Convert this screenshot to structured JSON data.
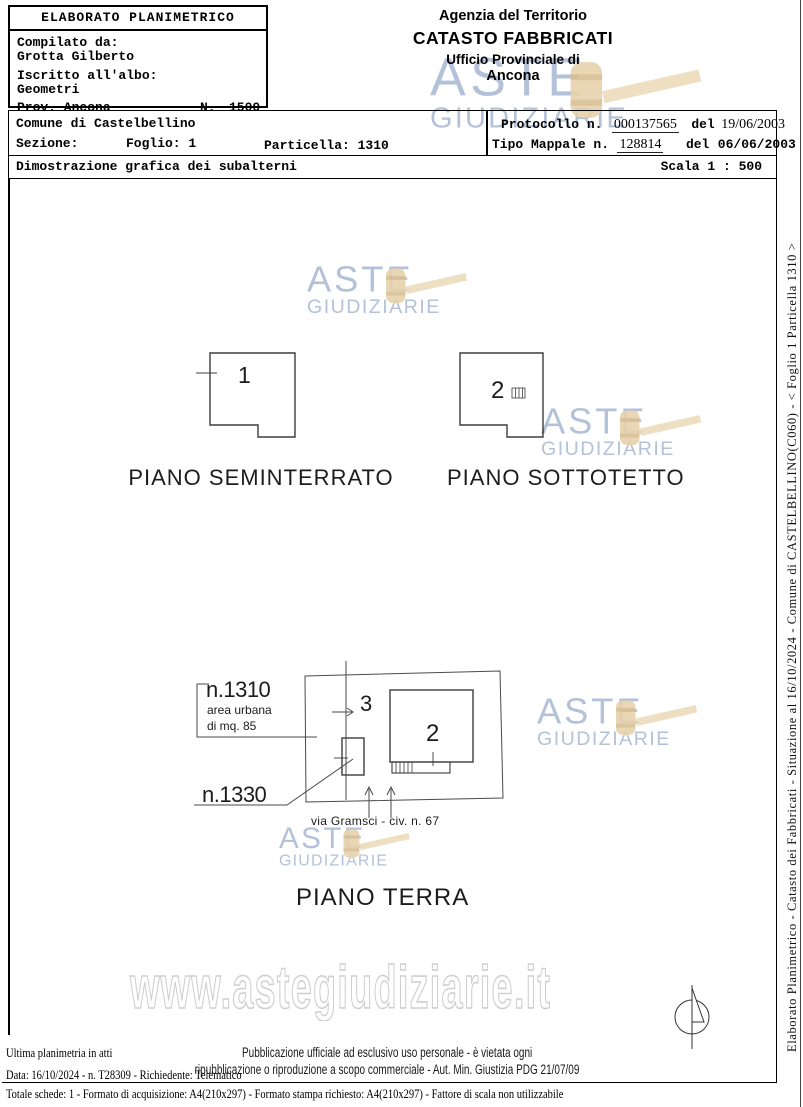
{
  "elaborato_box": {
    "title": "ELABORATO PLANIMETRICO",
    "compilato_label": "Compilato da:",
    "compilato_value": "Grotta Gilberto",
    "albo_label": "Iscritto all'albo:",
    "albo_value": "Geometri",
    "provincia": "Prov. Ancona",
    "numero_label": "N.",
    "numero_value": "1500"
  },
  "agenzia": {
    "line1": "Agenzia del Territorio",
    "line2": "CATASTO FABBRICATI",
    "line3": "Ufficio Provinciale di",
    "line4": "Ancona"
  },
  "intestazione": {
    "comune": "Comune di Castelbellino",
    "sezione": "Sezione:",
    "foglio": "Foglio: 1",
    "particella": "Particella: 1310",
    "protocollo_label": "Protocollo n.",
    "protocollo_value": "000137565",
    "protocollo_del": "del",
    "protocollo_data": "19/06/2003",
    "mappale_label": "Tipo Mappale n.",
    "mappale_value": "128814",
    "mappale_del": "del",
    "mappale_data": "06/06/2003",
    "descrizione": "Dimostrazione grafica dei subalterni",
    "scala": "Scala 1 : 500"
  },
  "planimetria": {
    "piano_seminterrato": {
      "label": "PIANO SEMINTERRATO",
      "sub": "1"
    },
    "piano_sottotetto": {
      "label": "PIANO SOTTOTETTO",
      "sub": "2"
    },
    "piano_terra": {
      "label": "PIANO TERRA",
      "sub3": "3",
      "sub2": "2",
      "particella_1310": "n.1310",
      "area_urbana": "area urbana",
      "mq": "di mq. 85",
      "particella_1330": "n.1330",
      "via": "via Gramsci - civ. n. 67"
    }
  },
  "watermark": {
    "aste": "ASTE",
    "giudiziarie": "GIUDIZIARIE",
    "url": "www.astegiudiziarie.it"
  },
  "footer": {
    "ultima": "Ultima planimetria in atti",
    "pubblicazione1": "Pubblicazione ufficiale ad esclusivo uso personale - è vietata ogni",
    "pubblicazione2": "ripubblicazione o riproduzione a scopo commerciale - Aut. Min. Giustizia PDG 21/07/09",
    "data_riga": "Data: 16/10/2024 - n. T28309 - Richiedente: Telematico",
    "totale_riga": "Totale schede: 1 - Formato di acquisizione: A4(210x297)  - Formato stampa richiesto: A4(210x297) - Fattore di scala non utilizzabile"
  },
  "margine_destro": "Elaborato Planimetrico - Catasto dei Fabbricati - Situazione al 16/10/2024 - Comune di CASTELBELLINO(C060) - < Foglio 1 Particella 1310 >",
  "colors": {
    "watermark_text": "#b3c2d8",
    "gavel": "#e7d2ac",
    "url_outline": "#cfcfcf",
    "line": "#000000"
  }
}
